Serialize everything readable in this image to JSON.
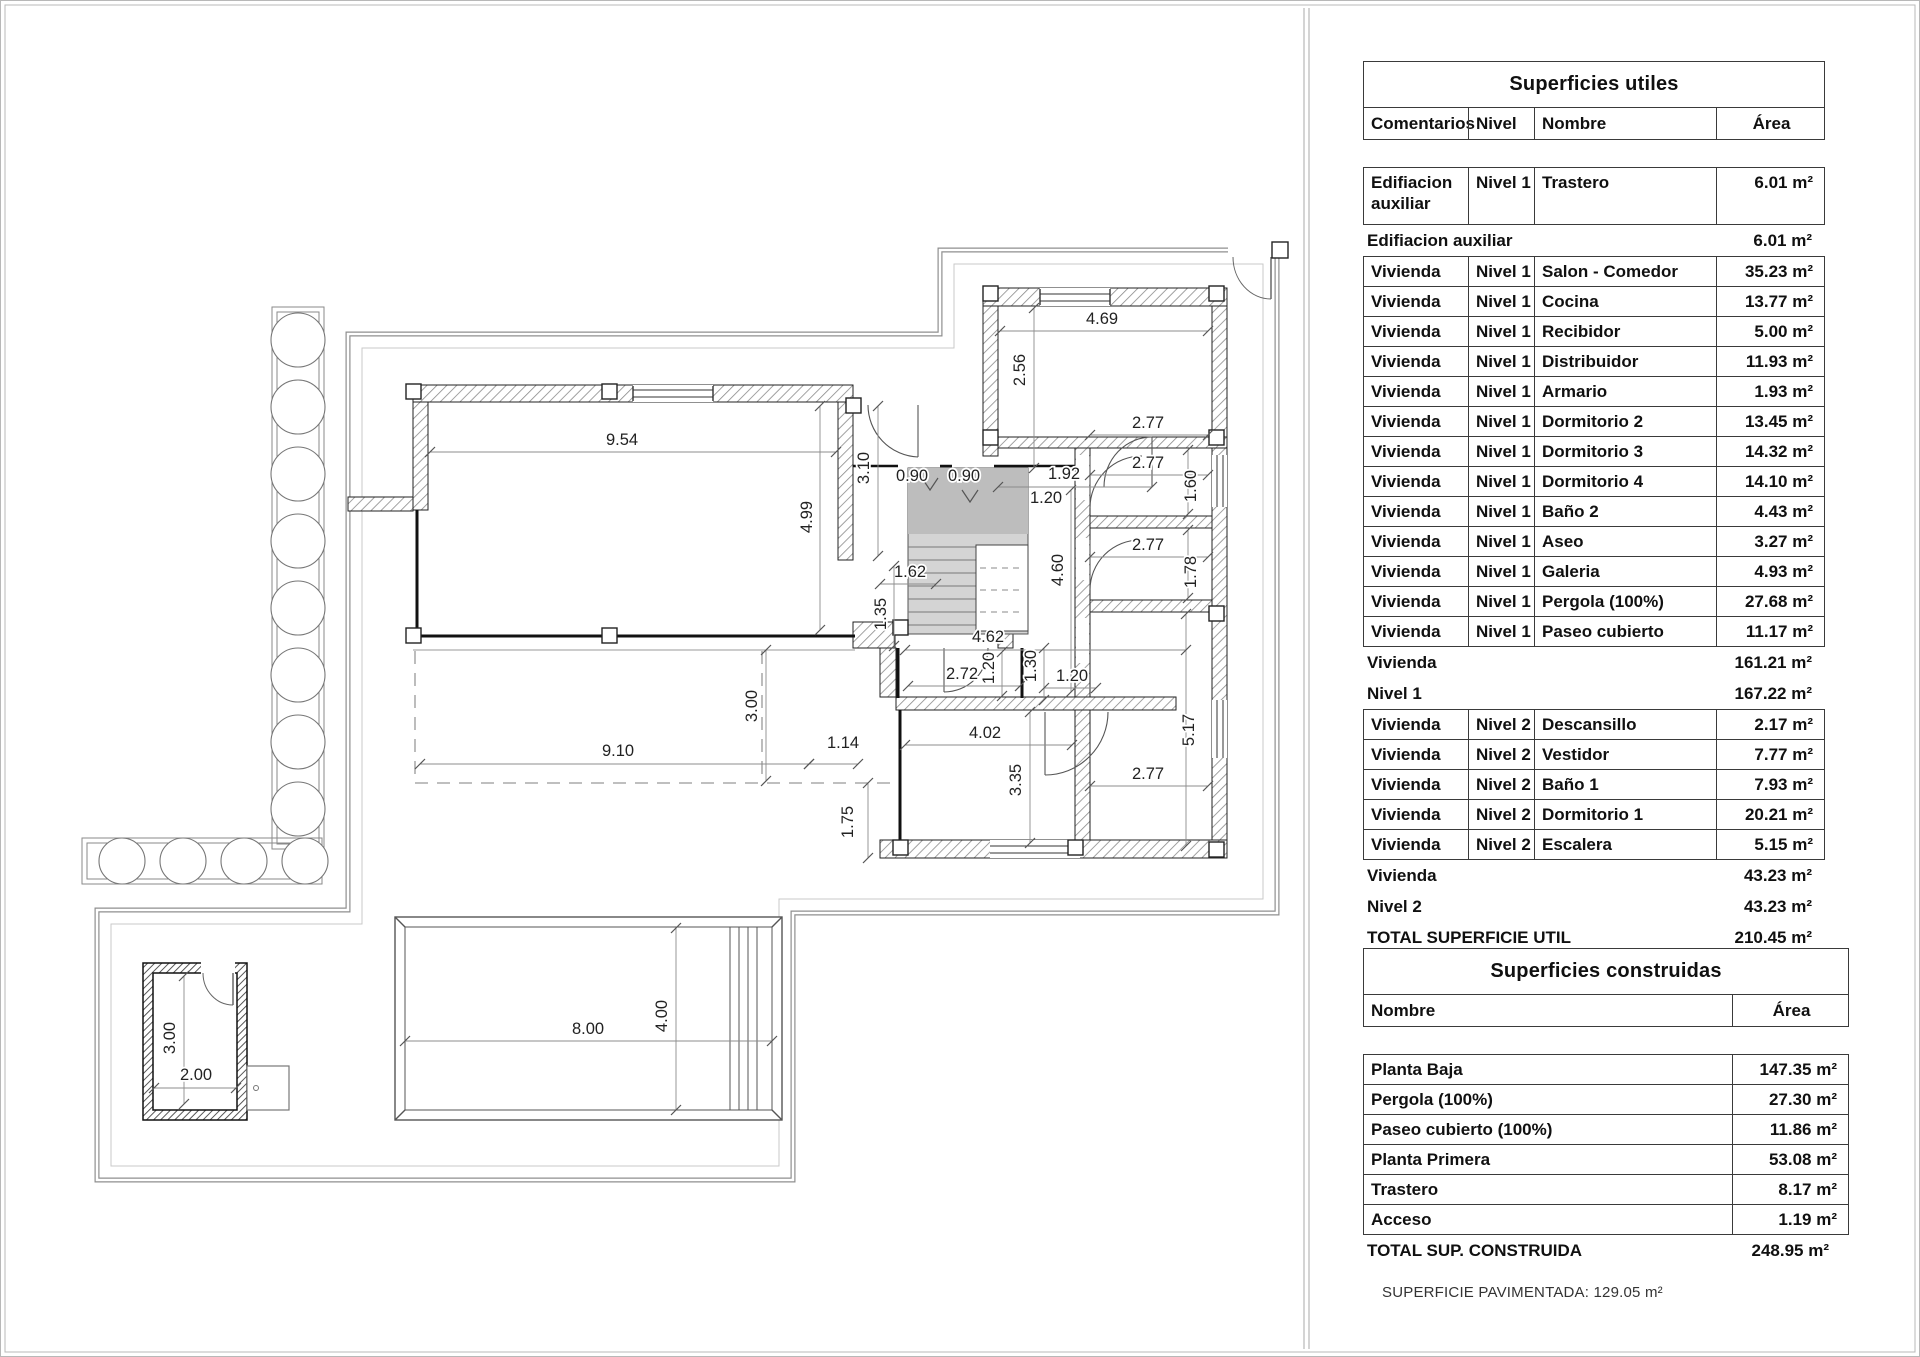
{
  "page": {
    "footnote": "SUPERFICIE PAVIMENTADA: 129.05 m²"
  },
  "tables": {
    "utiles": {
      "title": "Superficies utiles",
      "columns": [
        "Comentarios",
        "Nivel",
        "Nombre",
        "Área"
      ],
      "rows": [
        {
          "k": "box",
          "h": 2,
          "c": [
            "Edifiacion auxiliar",
            "Nivel 1",
            "Trastero",
            "6.01 m²"
          ]
        },
        {
          "k": "sum",
          "c": [
            "Edifiacion auxiliar",
            "6.01 m²"
          ]
        },
        {
          "k": "box",
          "c": [
            "Vivienda",
            "Nivel 1",
            "Salon - Comedor",
            "35.23 m²"
          ]
        },
        {
          "k": "box",
          "c": [
            "Vivienda",
            "Nivel 1",
            "Cocina",
            "13.77 m²"
          ]
        },
        {
          "k": "box",
          "c": [
            "Vivienda",
            "Nivel 1",
            "Recibidor",
            "5.00 m²"
          ]
        },
        {
          "k": "box",
          "c": [
            "Vivienda",
            "Nivel 1",
            "Distribuidor",
            "11.93 m²"
          ]
        },
        {
          "k": "box",
          "c": [
            "Vivienda",
            "Nivel 1",
            "Armario",
            "1.93 m²"
          ]
        },
        {
          "k": "box",
          "c": [
            "Vivienda",
            "Nivel 1",
            "Dormitorio 2",
            "13.45 m²"
          ]
        },
        {
          "k": "box",
          "c": [
            "Vivienda",
            "Nivel 1",
            "Dormitorio 3",
            "14.32 m²"
          ]
        },
        {
          "k": "box",
          "c": [
            "Vivienda",
            "Nivel 1",
            "Dormitorio 4",
            "14.10 m²"
          ]
        },
        {
          "k": "box",
          "c": [
            "Vivienda",
            "Nivel 1",
            "Baño 2",
            "4.43 m²"
          ]
        },
        {
          "k": "box",
          "c": [
            "Vivienda",
            "Nivel 1",
            "Aseo",
            "3.27 m²"
          ]
        },
        {
          "k": "box",
          "c": [
            "Vivienda",
            "Nivel 1",
            "Galeria",
            "4.93 m²"
          ]
        },
        {
          "k": "box",
          "c": [
            "Vivienda",
            "Nivel 1",
            "Pergola (100%)",
            "27.68 m²"
          ]
        },
        {
          "k": "box",
          "c": [
            "Vivienda",
            "Nivel 1",
            "Paseo cubierto (100%)",
            "11.17 m²"
          ]
        },
        {
          "k": "sum",
          "c": [
            "Vivienda",
            "161.21 m²"
          ]
        },
        {
          "k": "sum",
          "c": [
            "Nivel 1",
            "167.22 m²"
          ]
        },
        {
          "k": "box",
          "c": [
            "Vivienda",
            "Nivel 2",
            "Descansillo",
            "2.17 m²"
          ]
        },
        {
          "k": "box",
          "c": [
            "Vivienda",
            "Nivel 2",
            "Vestidor",
            "7.77 m²"
          ]
        },
        {
          "k": "box",
          "c": [
            "Vivienda",
            "Nivel 2",
            "Baño 1",
            "7.93 m²"
          ]
        },
        {
          "k": "box",
          "c": [
            "Vivienda",
            "Nivel 2",
            "Dormitorio 1",
            "20.21 m²"
          ]
        },
        {
          "k": "box",
          "c": [
            "Vivienda",
            "Nivel 2",
            "Escalera",
            "5.15 m²"
          ]
        },
        {
          "k": "sum",
          "c": [
            "Vivienda",
            "43.23 m²"
          ]
        },
        {
          "k": "sum",
          "c": [
            "Nivel 2",
            "43.23 m²"
          ]
        },
        {
          "k": "sum",
          "c": [
            "TOTAL SUPERFICIE UTIL",
            "210.45 m²"
          ]
        }
      ]
    },
    "construidas": {
      "title": "Superficies construidas",
      "columns": [
        "Nombre",
        "Área"
      ],
      "rows": [
        {
          "k": "box",
          "c": [
            "Planta Baja",
            "147.35 m²"
          ]
        },
        {
          "k": "box",
          "c": [
            "Pergola (100%)",
            "27.30 m²"
          ]
        },
        {
          "k": "box",
          "c": [
            "Paseo cubierto (100%)",
            "11.86 m²"
          ]
        },
        {
          "k": "box",
          "c": [
            "Planta Primera",
            "53.08 m²"
          ]
        },
        {
          "k": "box",
          "c": [
            "Trastero",
            "8.17 m²"
          ]
        },
        {
          "k": "box",
          "c": [
            "Acceso",
            "1.19 m²"
          ]
        },
        {
          "k": "sum",
          "c": [
            "TOTAL SUP. CONSTRUIDA",
            "248.95 m²"
          ]
        }
      ]
    }
  },
  "plan": {
    "dimensions": [
      {
        "t": "9.54",
        "lx": 622,
        "ly": 445,
        "x1": 430,
        "y1": 452,
        "x2": 836,
        "y2": 452
      },
      {
        "t": "4.99",
        "lx": 812,
        "ly": 517,
        "r": -90,
        "x1": 820,
        "y1": 406,
        "x2": 820,
        "y2": 630
      },
      {
        "t": "3.10",
        "lx": 869,
        "ly": 468,
        "r": -90,
        "x1": 878,
        "y1": 406,
        "x2": 878,
        "y2": 556
      },
      {
        "t": "0.90",
        "lx": 912,
        "ly": 481
      },
      {
        "t": "0.90",
        "lx": 964,
        "ly": 481
      },
      {
        "t": "1.92",
        "lx": 1064,
        "ly": 479,
        "x1": 998,
        "y1": 487,
        "x2": 1152,
        "y2": 487
      },
      {
        "t": "1.20",
        "lx": 1046,
        "ly": 503
      },
      {
        "t": "2.56",
        "lx": 1025,
        "ly": 370,
        "r": -90,
        "x1": 1034,
        "y1": 308,
        "x2": 1034,
        "y2": 468
      },
      {
        "t": "4.69",
        "lx": 1102,
        "ly": 324,
        "x1": 1000,
        "y1": 331,
        "x2": 1208,
        "y2": 331
      },
      {
        "t": "2.77",
        "lx": 1148,
        "ly": 428,
        "x1": 1090,
        "y1": 435,
        "x2": 1208,
        "y2": 435
      },
      {
        "t": "2.77",
        "lx": 1148,
        "ly": 468,
        "x1": 1090,
        "y1": 475,
        "x2": 1208,
        "y2": 475
      },
      {
        "t": "1.60",
        "lx": 1196,
        "ly": 486,
        "r": -90,
        "x1": 1188,
        "y1": 450,
        "x2": 1188,
        "y2": 514
      },
      {
        "t": "2.77",
        "lx": 1148,
        "ly": 550,
        "x1": 1090,
        "y1": 557,
        "x2": 1208,
        "y2": 557
      },
      {
        "t": "1.78",
        "lx": 1196,
        "ly": 572,
        "r": -90,
        "x1": 1188,
        "y1": 530,
        "x2": 1188,
        "y2": 598
      },
      {
        "t": "5.17",
        "lx": 1194,
        "ly": 730,
        "r": -90,
        "x1": 1186,
        "y1": 614,
        "x2": 1186,
        "y2": 846
      },
      {
        "t": "2.77",
        "lx": 1148,
        "ly": 779,
        "x1": 1090,
        "y1": 786,
        "x2": 1208,
        "y2": 786
      },
      {
        "t": "4.60",
        "lx": 1063,
        "ly": 570,
        "r": -90,
        "x1": 1071,
        "y1": 490,
        "x2": 1071,
        "y2": 692
      },
      {
        "t": "1.62",
        "lx": 910,
        "ly": 577,
        "x1": 880,
        "y1": 584,
        "x2": 936,
        "y2": 584
      },
      {
        "t": "1.35",
        "lx": 886,
        "ly": 614,
        "r": -90,
        "x1": 894,
        "y1": 566,
        "x2": 894,
        "y2": 646
      },
      {
        "t": "4.62",
        "lx": 988,
        "ly": 642,
        "x1": 905,
        "y1": 650,
        "x2": 1186,
        "y2": 650
      },
      {
        "t": "2.72",
        "lx": 962,
        "ly": 679,
        "x1": 908,
        "y1": 686,
        "x2": 1020,
        "y2": 686
      },
      {
        "t": "1.20",
        "lx": 994,
        "ly": 668,
        "r": -90,
        "x1": 1002,
        "y1": 652,
        "x2": 1002,
        "y2": 696
      },
      {
        "t": "1.30",
        "lx": 1036,
        "ly": 666,
        "r": -90,
        "x1": 1044,
        "y1": 648,
        "x2": 1044,
        "y2": 700
      },
      {
        "t": "1.20",
        "lx": 1072,
        "ly": 681,
        "x1": 1044,
        "y1": 688,
        "x2": 1096,
        "y2": 688
      },
      {
        "t": "4.02",
        "lx": 985,
        "ly": 738,
        "x1": 905,
        "y1": 745,
        "x2": 1072,
        "y2": 745
      },
      {
        "t": "3.35",
        "lx": 1021,
        "ly": 780,
        "r": -90,
        "x1": 1030,
        "y1": 712,
        "x2": 1030,
        "y2": 843
      },
      {
        "t": "3.00",
        "lx": 757,
        "ly": 706,
        "r": -90,
        "x1": 766,
        "y1": 650,
        "x2": 766,
        "y2": 781
      },
      {
        "t": "9.10",
        "lx": 618,
        "ly": 756,
        "x1": 420,
        "y1": 764,
        "x2": 809,
        "y2": 764
      },
      {
        "t": "1.14",
        "lx": 843,
        "ly": 748,
        "x1": 809,
        "y1": 764,
        "x2": 858,
        "y2": 764
      },
      {
        "t": "1.75",
        "lx": 853,
        "ly": 822,
        "r": -90,
        "x1": 868,
        "y1": 783,
        "x2": 868,
        "y2": 858
      },
      {
        "t": "8.00",
        "lx": 588,
        "ly": 1034,
        "x1": 405,
        "y1": 1041,
        "x2": 772,
        "y2": 1041
      },
      {
        "t": "4.00",
        "lx": 667,
        "ly": 1016,
        "r": -90,
        "x1": 676,
        "y1": 928,
        "x2": 676,
        "y2": 1110
      },
      {
        "t": "3.00",
        "lx": 175,
        "ly": 1038,
        "r": -90,
        "x1": 184,
        "y1": 976,
        "x2": 184,
        "y2": 1104
      },
      {
        "t": "2.00",
        "lx": 196,
        "ly": 1080,
        "x1": 154,
        "y1": 1088,
        "x2": 236,
        "y2": 1088
      }
    ]
  }
}
